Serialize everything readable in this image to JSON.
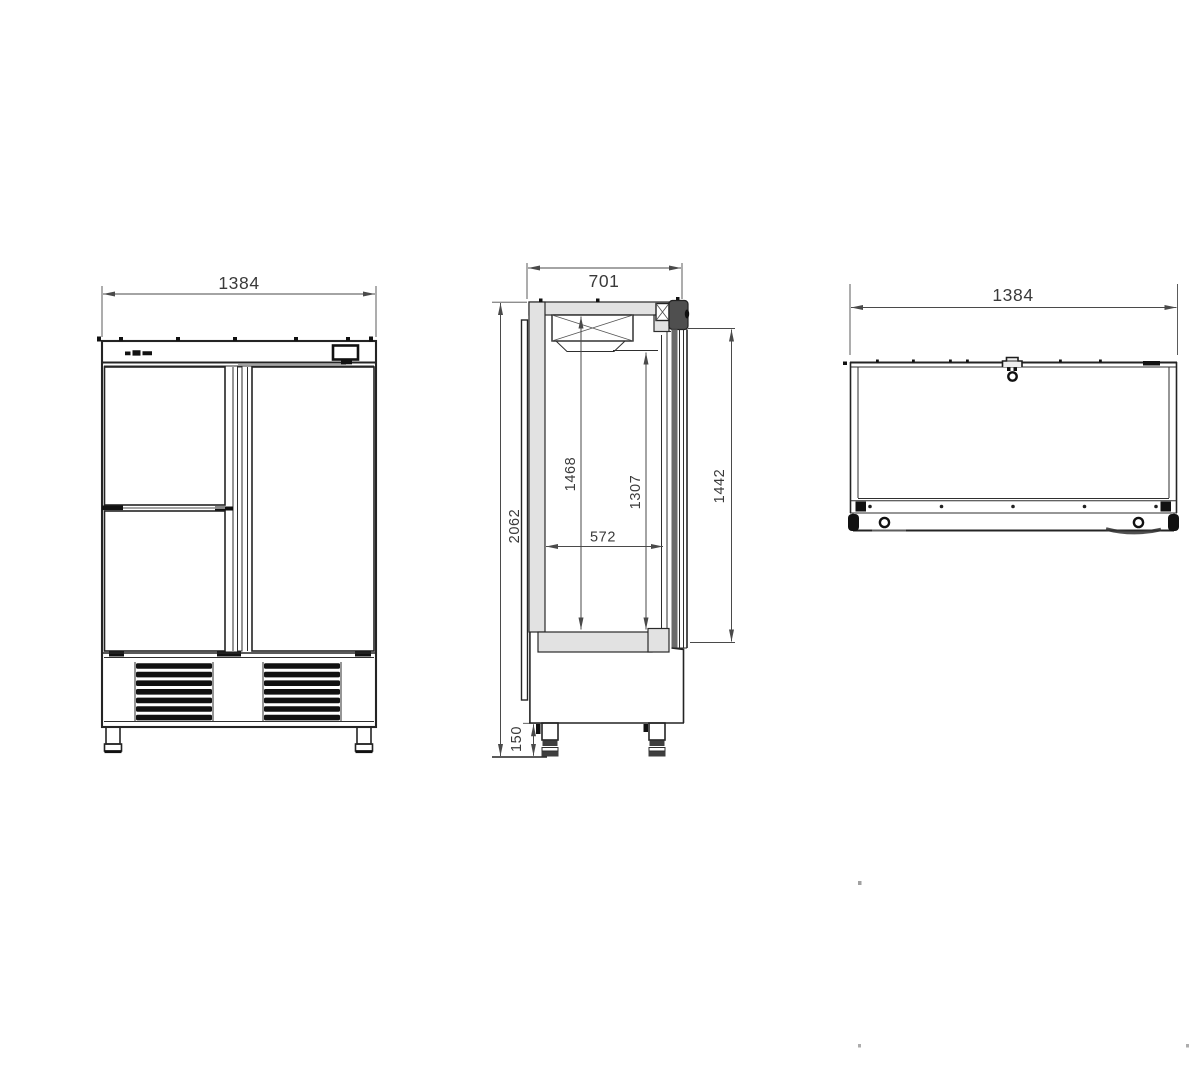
{
  "drawing": {
    "description": "Three-view technical drawing of a two-section upright refrigerated cabinet",
    "views": {
      "front": {
        "name": "front-view",
        "dims": {
          "overall_width": "1384"
        }
      },
      "side": {
        "name": "side-view",
        "dims": {
          "overall_depth": "701",
          "overall_height": "2062",
          "interior_height_rear": "1468",
          "interior_height_front": "1307",
          "interior_depth": "572",
          "door_height": "1442",
          "leg_height": "150"
        }
      },
      "top": {
        "name": "top-view",
        "dims": {
          "overall_width": "1384"
        }
      }
    },
    "colors": {
      "line": "#242424",
      "dim_line": "#4a4a4a",
      "dim_text": "#3a3a3a",
      "panel_fill": "#e2e2e2",
      "door_core": "#6a6a6a",
      "background": "#ffffff"
    }
  }
}
